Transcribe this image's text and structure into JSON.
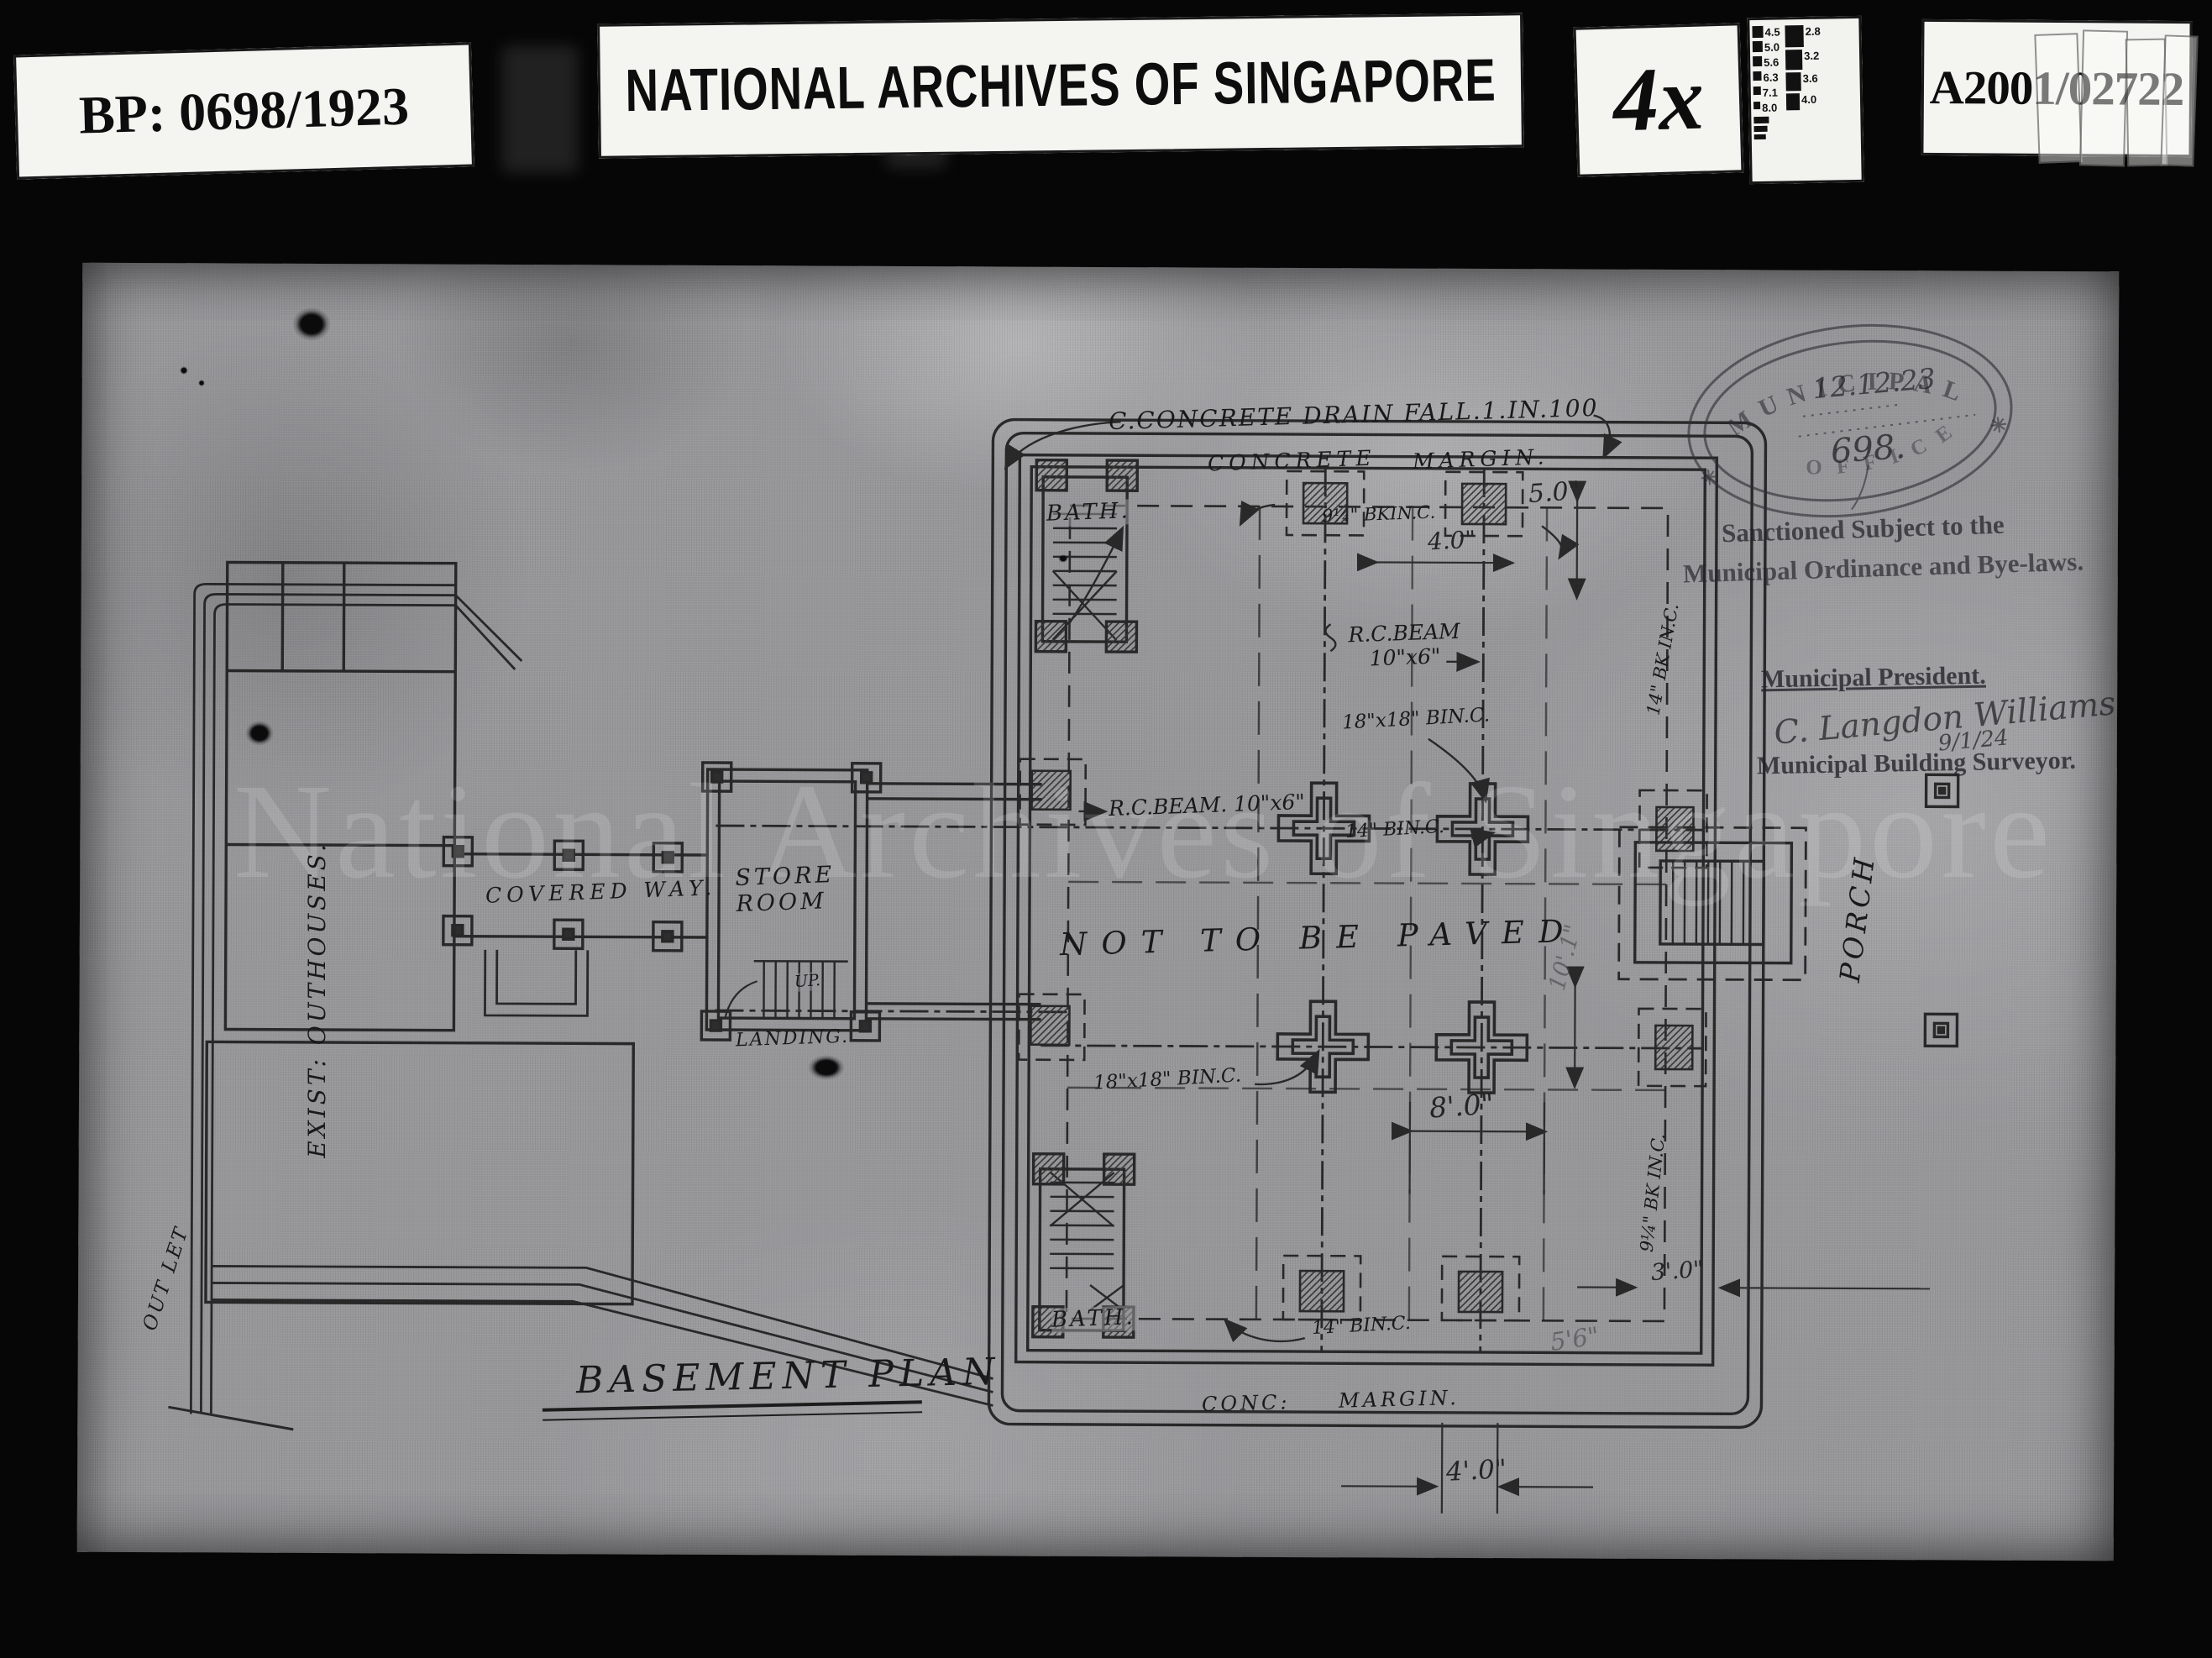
{
  "header": {
    "bp_label": "BP: 0698/1923",
    "archive_label": "NATIONAL ARCHIVES OF SINGAPORE",
    "magnification_label": "4x",
    "accession_label": "A2001/02722",
    "scale_chart": {
      "left_column": [
        "4.5",
        "5.0",
        "5.6",
        "6.3",
        "7.1",
        "8.0"
      ],
      "right_column": [
        "2.8",
        "3.2",
        "3.6",
        "4.0"
      ]
    }
  },
  "stamps": {
    "oval_top": "MUNICIPAL",
    "oval_bottom": "OFFICE",
    "oval_star_left": "✳",
    "oval_star_right": "✳",
    "handwritten_date": "12.12.23",
    "handwritten_number": "698.",
    "sanction_line1": "Sanctioned Subject to the",
    "sanction_line2": "Municipal Ordinance and Bye-laws.",
    "president_label": "Municipal President.",
    "signature": "C. Langdon Williams",
    "signature_date": "9/1/24",
    "surveyor_label": "Municipal Building Surveyor."
  },
  "plan": {
    "title": "BASEMENT PLAN",
    "watermark": "National Archives of Singapore",
    "labels": {
      "drain_note": "C.CONCRETE DRAIN FALL.1.IN.100",
      "concrete": "CONCRETE",
      "margin": "MARGIN.",
      "bk_top": "9¼\" BKIN.C.",
      "rc_beam_upper": "R.C.BEAM\n10\"x6\"",
      "rc_beam_mid": "R.C.BEAM. 10\"x6\"",
      "bk_mid": "14\" BIN.C.",
      "col_note_top": "18\"x18\" BIN.C.",
      "col_note_bottom": "18\"x18\" BIN.C.",
      "not_paved": "NOT TO BE PAVED",
      "bath_top": "BATH.",
      "bath_bottom": "BATH.",
      "bk_bottom": "14\" BIN.C.",
      "conc_margin": "CONC:  MARGIN.",
      "bk_right_top": "14\" BK IN.C.",
      "bk_right_bottom": "9¼\" BK IN.C.",
      "porch": "PORCH",
      "store_room": "STORE\n  ROOM",
      "up": "UP.",
      "landing": "LANDING.",
      "covered_way": "COVERED WAY.",
      "outhouses": "EXIST: OUTHOUSES.",
      "outlet": "OUT LET"
    },
    "dimensions": {
      "d5_0": "5.0\"",
      "d4_0": "4.0\"",
      "d8_0": "8'.0\"",
      "d10_1": "10'.1\"",
      "d3_0": "3'.0\"",
      "d5_6": "5'6\"",
      "d4_0b": "4'.0\""
    }
  }
}
